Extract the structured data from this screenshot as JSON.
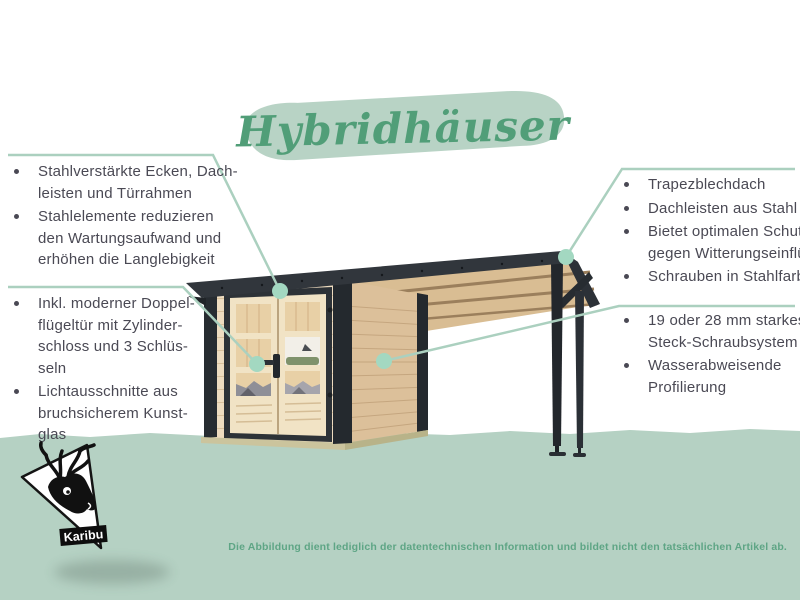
{
  "title": {
    "text": "Hybridhäuser"
  },
  "callouts": {
    "top_left": {
      "items": [
        {
          "lines": [
            "Stahlverstärkte Ecken, Dach-",
            "leisten und Türrahmen"
          ]
        },
        {
          "lines": [
            "Stahlelemente reduzieren",
            "den Wartungsaufwand und",
            "erhöhen die Langlebigkeit"
          ]
        }
      ]
    },
    "bottom_left": {
      "items": [
        {
          "lines": [
            "Inkl. moderner Doppel-",
            "flügeltür mit Zylinder-",
            "schloss und 3 Schlüs-",
            "seln"
          ]
        },
        {
          "lines": [
            "Lichtausschnitte aus",
            "bruchsicherem Kunst-",
            "glas"
          ]
        }
      ]
    },
    "top_right": {
      "items": [
        {
          "lines": [
            "Trapezblechdach"
          ]
        },
        {
          "lines": [
            "Dachleisten aus Stahl"
          ]
        },
        {
          "lines": [
            "Bietet optimalen Schutz",
            "gegen Witterungseinflüsse"
          ]
        },
        {
          "lines": [
            "Schrauben in Stahlfarbe"
          ]
        }
      ]
    },
    "bottom_right": {
      "items": [
        {
          "lines": [
            "19 oder 28 mm starkes",
            "Steck-Schraubsystem"
          ]
        },
        {
          "lines": [
            "Wasserabweisende",
            "Profilierung"
          ]
        }
      ]
    }
  },
  "logo": {
    "brand": "Karibu"
  },
  "disclaimer": "Die Abbildung dient lediglich der datentechnischen Information und bildet nicht den tatsächlichen Artikel ab.",
  "colors": {
    "accent_green": "#519e78",
    "brush_green": "#b8d3c5",
    "band_green": "#b5d1c3",
    "leader_line": "#abd0bf",
    "leader_dot": "#a3d8c1",
    "text_dark": "#4a4954",
    "disclaimer_green": "#5ea585",
    "roof_anthracite": "#31363c",
    "wood_front": "#eedcc0",
    "wood_side": "#dcc09a"
  }
}
